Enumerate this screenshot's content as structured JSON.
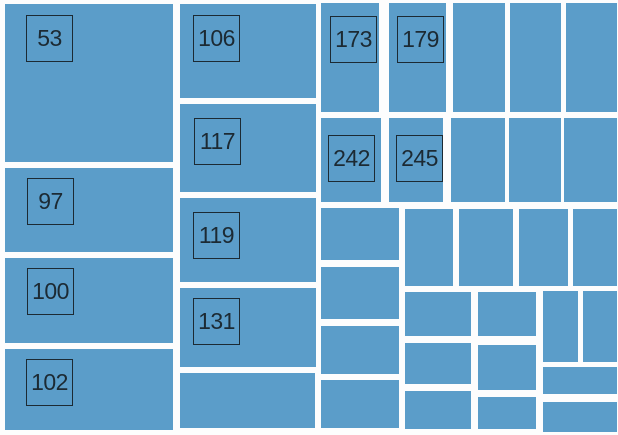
{
  "chart_data": {
    "type": "treemap",
    "title": "",
    "canvas": {
      "width": 618,
      "height": 435
    },
    "background": "#fdfdfd",
    "cell_color": "#5b9dc9",
    "gutter_color": "#fdfdfd",
    "label_box": {
      "size": 47,
      "border_color": "#1c2a33",
      "text_color": "#1c2a33",
      "font_size": 23
    },
    "labeled_values": [
      53,
      97,
      100,
      102,
      106,
      117,
      119,
      131,
      173,
      179,
      242,
      245
    ],
    "unlabeled_cell_count": 25,
    "legend": "none",
    "axes": "none",
    "cells": [
      {
        "label": "53",
        "x": 5,
        "y": 4,
        "w": 168,
        "h": 158,
        "lx": 21,
        "ly": 11
      },
      {
        "label": "97",
        "x": 5,
        "y": 168,
        "w": 168,
        "h": 84,
        "lx": 22,
        "ly": 10
      },
      {
        "label": "100",
        "x": 5,
        "y": 258,
        "w": 168,
        "h": 85,
        "lx": 22,
        "ly": 10
      },
      {
        "label": "102",
        "x": 5,
        "y": 349,
        "w": 168,
        "h": 81,
        "lx": 21,
        "ly": 10
      },
      {
        "label": "106",
        "x": 180,
        "y": 4,
        "w": 136,
        "h": 94,
        "lx": 13,
        "ly": 11
      },
      {
        "label": "117",
        "x": 180,
        "y": 104,
        "w": 136,
        "h": 88,
        "lx": 14,
        "ly": 14
      },
      {
        "label": "119",
        "x": 180,
        "y": 198,
        "w": 136,
        "h": 84,
        "lx": 13,
        "ly": 14
      },
      {
        "label": "131",
        "x": 180,
        "y": 288,
        "w": 136,
        "h": 79,
        "lx": 13,
        "ly": 10
      },
      {
        "label": "",
        "x": 180,
        "y": 373,
        "w": 135,
        "h": 55
      },
      {
        "label": "173",
        "x": 321,
        "y": 3,
        "w": 58,
        "h": 109,
        "lx": 9,
        "ly": 13
      },
      {
        "label": "179",
        "x": 389,
        "y": 3,
        "w": 57,
        "h": 109,
        "lx": 8,
        "ly": 13
      },
      {
        "label": "",
        "x": 453,
        "y": 3,
        "w": 52,
        "h": 109
      },
      {
        "label": "",
        "x": 510,
        "y": 3,
        "w": 51,
        "h": 109
      },
      {
        "label": "",
        "x": 566,
        "y": 3,
        "w": 51,
        "h": 109
      },
      {
        "label": "242",
        "x": 321,
        "y": 118,
        "w": 60,
        "h": 84,
        "lx": 7,
        "ly": 17
      },
      {
        "label": "245",
        "x": 389,
        "y": 118,
        "w": 54,
        "h": 84,
        "lx": 7,
        "ly": 17
      },
      {
        "label": "",
        "x": 451,
        "y": 118,
        "w": 54,
        "h": 84
      },
      {
        "label": "",
        "x": 509,
        "y": 118,
        "w": 52,
        "h": 84
      },
      {
        "label": "",
        "x": 564,
        "y": 118,
        "w": 53,
        "h": 84
      },
      {
        "label": "",
        "x": 321,
        "y": 208,
        "w": 78,
        "h": 52
      },
      {
        "label": "",
        "x": 321,
        "y": 267,
        "w": 78,
        "h": 52
      },
      {
        "label": "",
        "x": 321,
        "y": 326,
        "w": 78,
        "h": 48
      },
      {
        "label": "",
        "x": 321,
        "y": 380,
        "w": 78,
        "h": 48
      },
      {
        "label": "",
        "x": 405,
        "y": 209,
        "w": 48,
        "h": 77
      },
      {
        "label": "",
        "x": 459,
        "y": 209,
        "w": 54,
        "h": 77
      },
      {
        "label": "",
        "x": 519,
        "y": 209,
        "w": 49,
        "h": 77
      },
      {
        "label": "",
        "x": 573,
        "y": 209,
        "w": 44,
        "h": 77
      },
      {
        "label": "",
        "x": 405,
        "y": 292,
        "w": 66,
        "h": 44
      },
      {
        "label": "",
        "x": 405,
        "y": 343,
        "w": 66,
        "h": 41
      },
      {
        "label": "",
        "x": 405,
        "y": 391,
        "w": 66,
        "h": 38
      },
      {
        "label": "",
        "x": 478,
        "y": 292,
        "w": 58,
        "h": 44
      },
      {
        "label": "",
        "x": 478,
        "y": 345,
        "w": 58,
        "h": 45
      },
      {
        "label": "",
        "x": 478,
        "y": 397,
        "w": 58,
        "h": 32
      },
      {
        "label": "",
        "x": 543,
        "y": 291,
        "w": 35,
        "h": 71
      },
      {
        "label": "",
        "x": 583,
        "y": 291,
        "w": 34,
        "h": 71
      },
      {
        "label": "",
        "x": 543,
        "y": 367,
        "w": 74,
        "h": 27
      },
      {
        "label": "",
        "x": 543,
        "y": 402,
        "w": 74,
        "h": 30
      }
    ]
  }
}
